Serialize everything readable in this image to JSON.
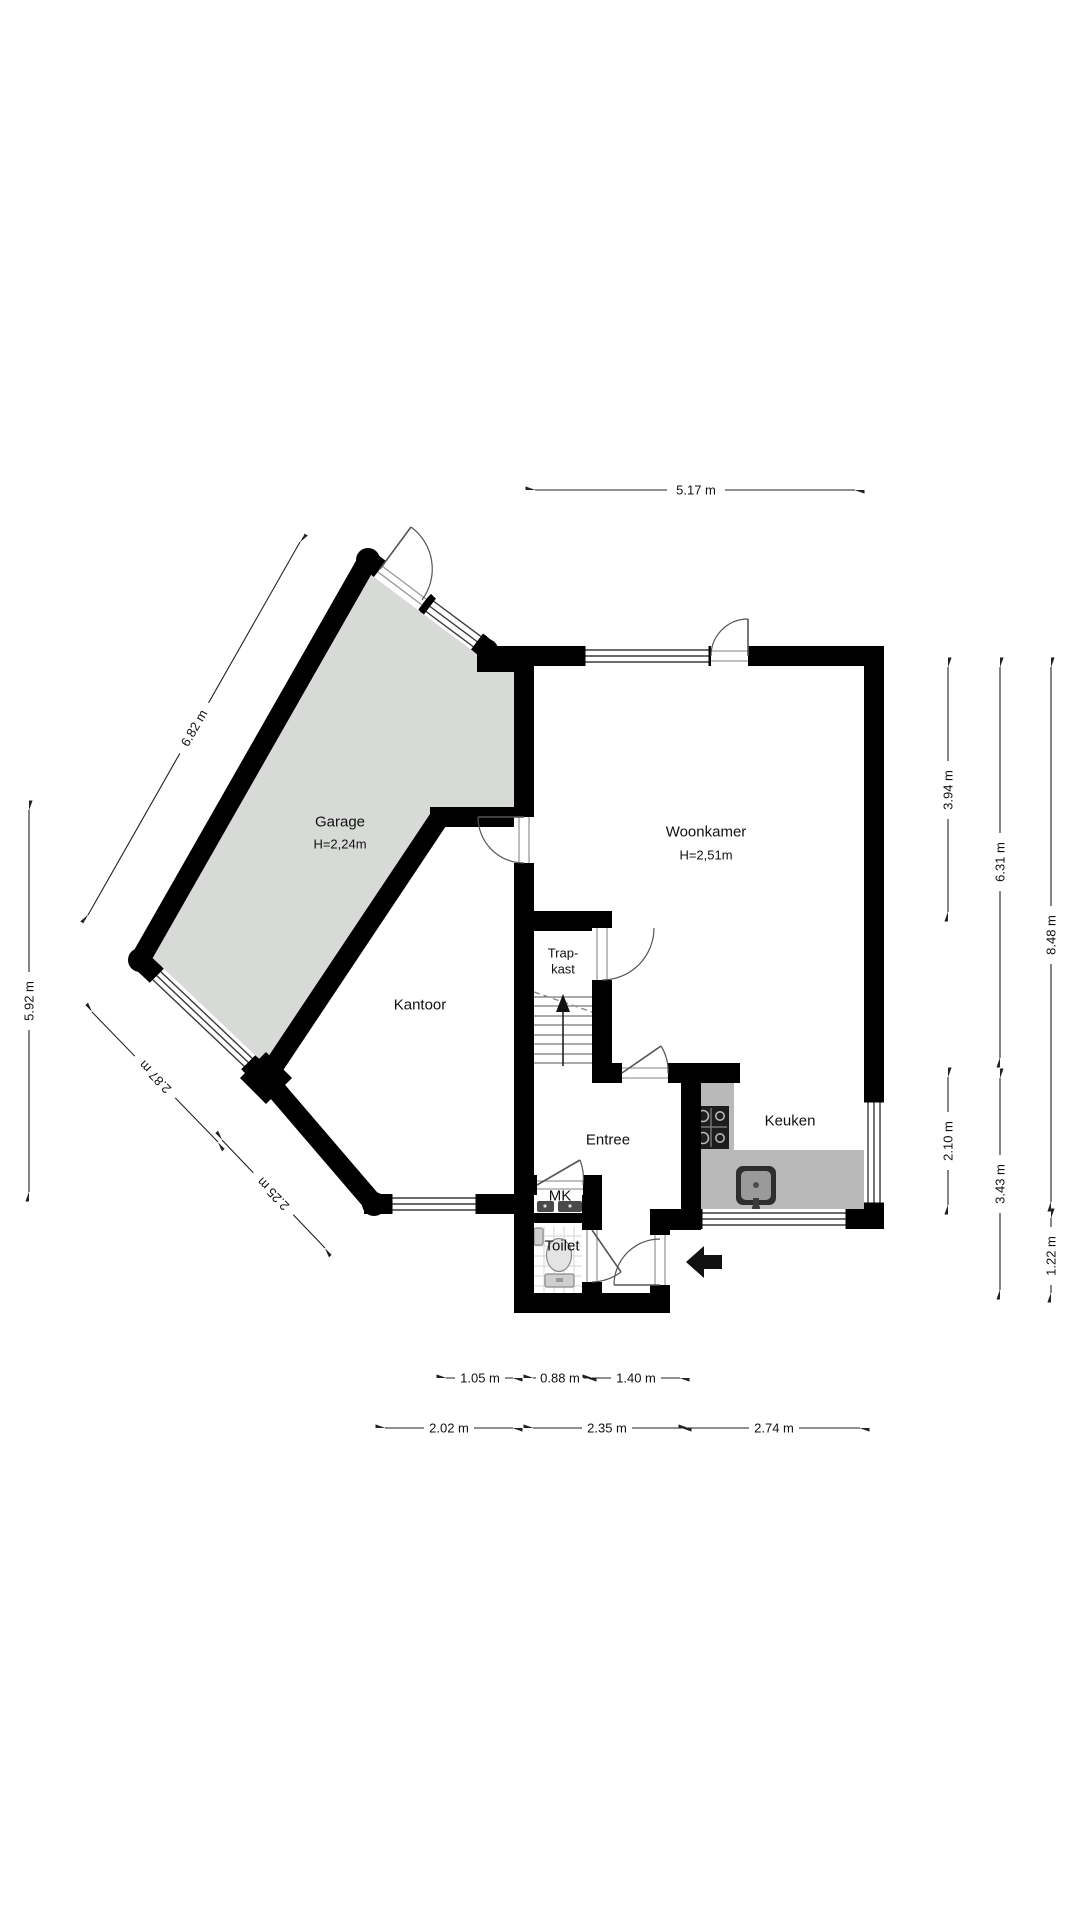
{
  "plan": {
    "title": "floor-plan-ground-floor",
    "rooms": {
      "garage": {
        "label": "Garage",
        "height": "H=2,24m"
      },
      "woonkamer": {
        "label": "Woonkamer",
        "height": "H=2,51m"
      },
      "kantoor": {
        "label": "Kantoor"
      },
      "trapkast": {
        "line1": "Trap-",
        "line2": "kast"
      },
      "entree": {
        "label": "Entree"
      },
      "mk": {
        "label": "MK"
      },
      "toilet": {
        "label": "Toilet"
      },
      "keuken": {
        "label": "Keuken"
      }
    },
    "dimensions": {
      "top": "5.17 m",
      "left_garage_nw": "6.82 m",
      "left_height": "5.92 m",
      "left_garage_sw": "2.87 m",
      "left_kantoor_sw": "2.25 m",
      "right_woonkamer": "3.94 m",
      "right_mid": "6.31 m",
      "right_total": "8.48 m",
      "right_keuken": "2.10 m",
      "right_lower": "3.43 m",
      "right_entry": "1.22 m",
      "bottom_inner": [
        "1.05 m",
        "0.88 m",
        "1.40 m"
      ],
      "bottom_outer": [
        "2.02 m",
        "2.35 m",
        "2.74 m"
      ]
    },
    "colors": {
      "wall": "#000000",
      "garage_fill": "#d7dad7",
      "counter": "#b9b9b9",
      "stove": "#1d1d1d"
    }
  }
}
